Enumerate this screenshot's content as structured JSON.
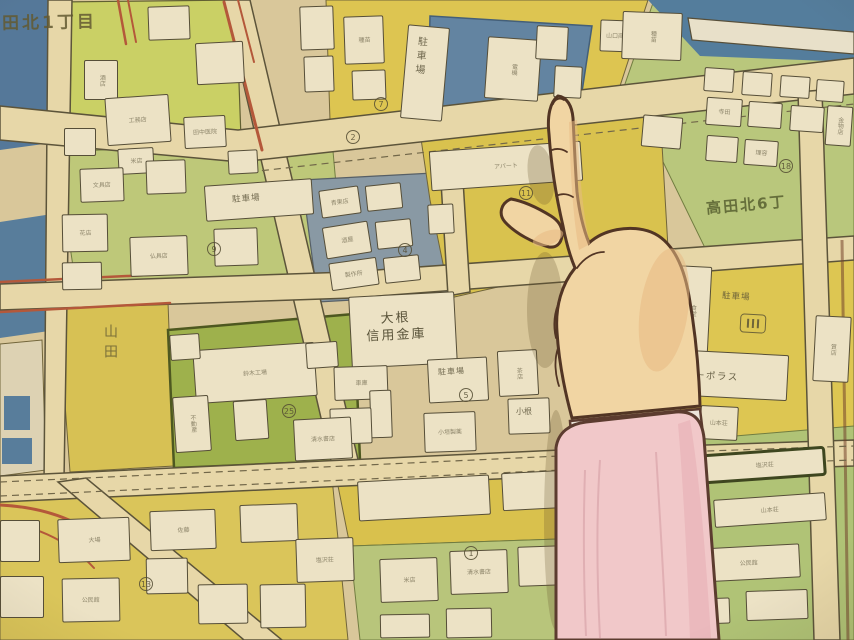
{
  "scene": {
    "description": "Hand-drawn anime frame: a hand with index finger extended points at a Japanese residential city map",
    "pointing_hand": "index finger pointing at yellow block near circled lot 11",
    "sleeve_color": "#f2c9ce",
    "cuff_color": "#ece7df",
    "skin_color": "#f2d6a6"
  },
  "map": {
    "legible": {
      "d1": "田北1丁目",
      "d2": "高田北6丁",
      "bank1": "大根",
      "bank2": "信用金庫",
      "parking": "駐車場",
      "corpo": "コーポラス",
      "kone": "小根",
      "yamada": "山田"
    },
    "circled_numbers": [
      "7",
      "2",
      "11",
      "18",
      "5",
      "4",
      "1",
      "13",
      "25",
      "9"
    ],
    "illegible_micro_labels": [
      "酒店",
      "工務店",
      "米店",
      "田中医院",
      "山口商店",
      "電機",
      "種苗",
      "倉庫",
      "寺田",
      "金物店",
      "理容",
      "文具店",
      "花店",
      "仏具店",
      "青果店",
      "酒屋",
      "製作所",
      "アパート",
      "食堂",
      "山本荘",
      "質店",
      "茶店",
      "車庫",
      "小垣製薬",
      "鈴木工場",
      "不動産",
      "清水書店",
      "大場",
      "佐藤",
      "塩沢荘",
      "公民館"
    ],
    "colors": {
      "base_cream": "#d9c89c",
      "road": "#e7d8ac",
      "yellow_block": "#d9c453",
      "light_green_block": "#bcc97c",
      "bright_green_block": "#c9d168",
      "dark_green_block": "#9ab04d",
      "blue_block": "#5d81a3",
      "river_blue": "#4d7a9e",
      "building_white": "#ece4cb",
      "red_road_line": "#b05438",
      "outline": "#4e4836"
    }
  }
}
